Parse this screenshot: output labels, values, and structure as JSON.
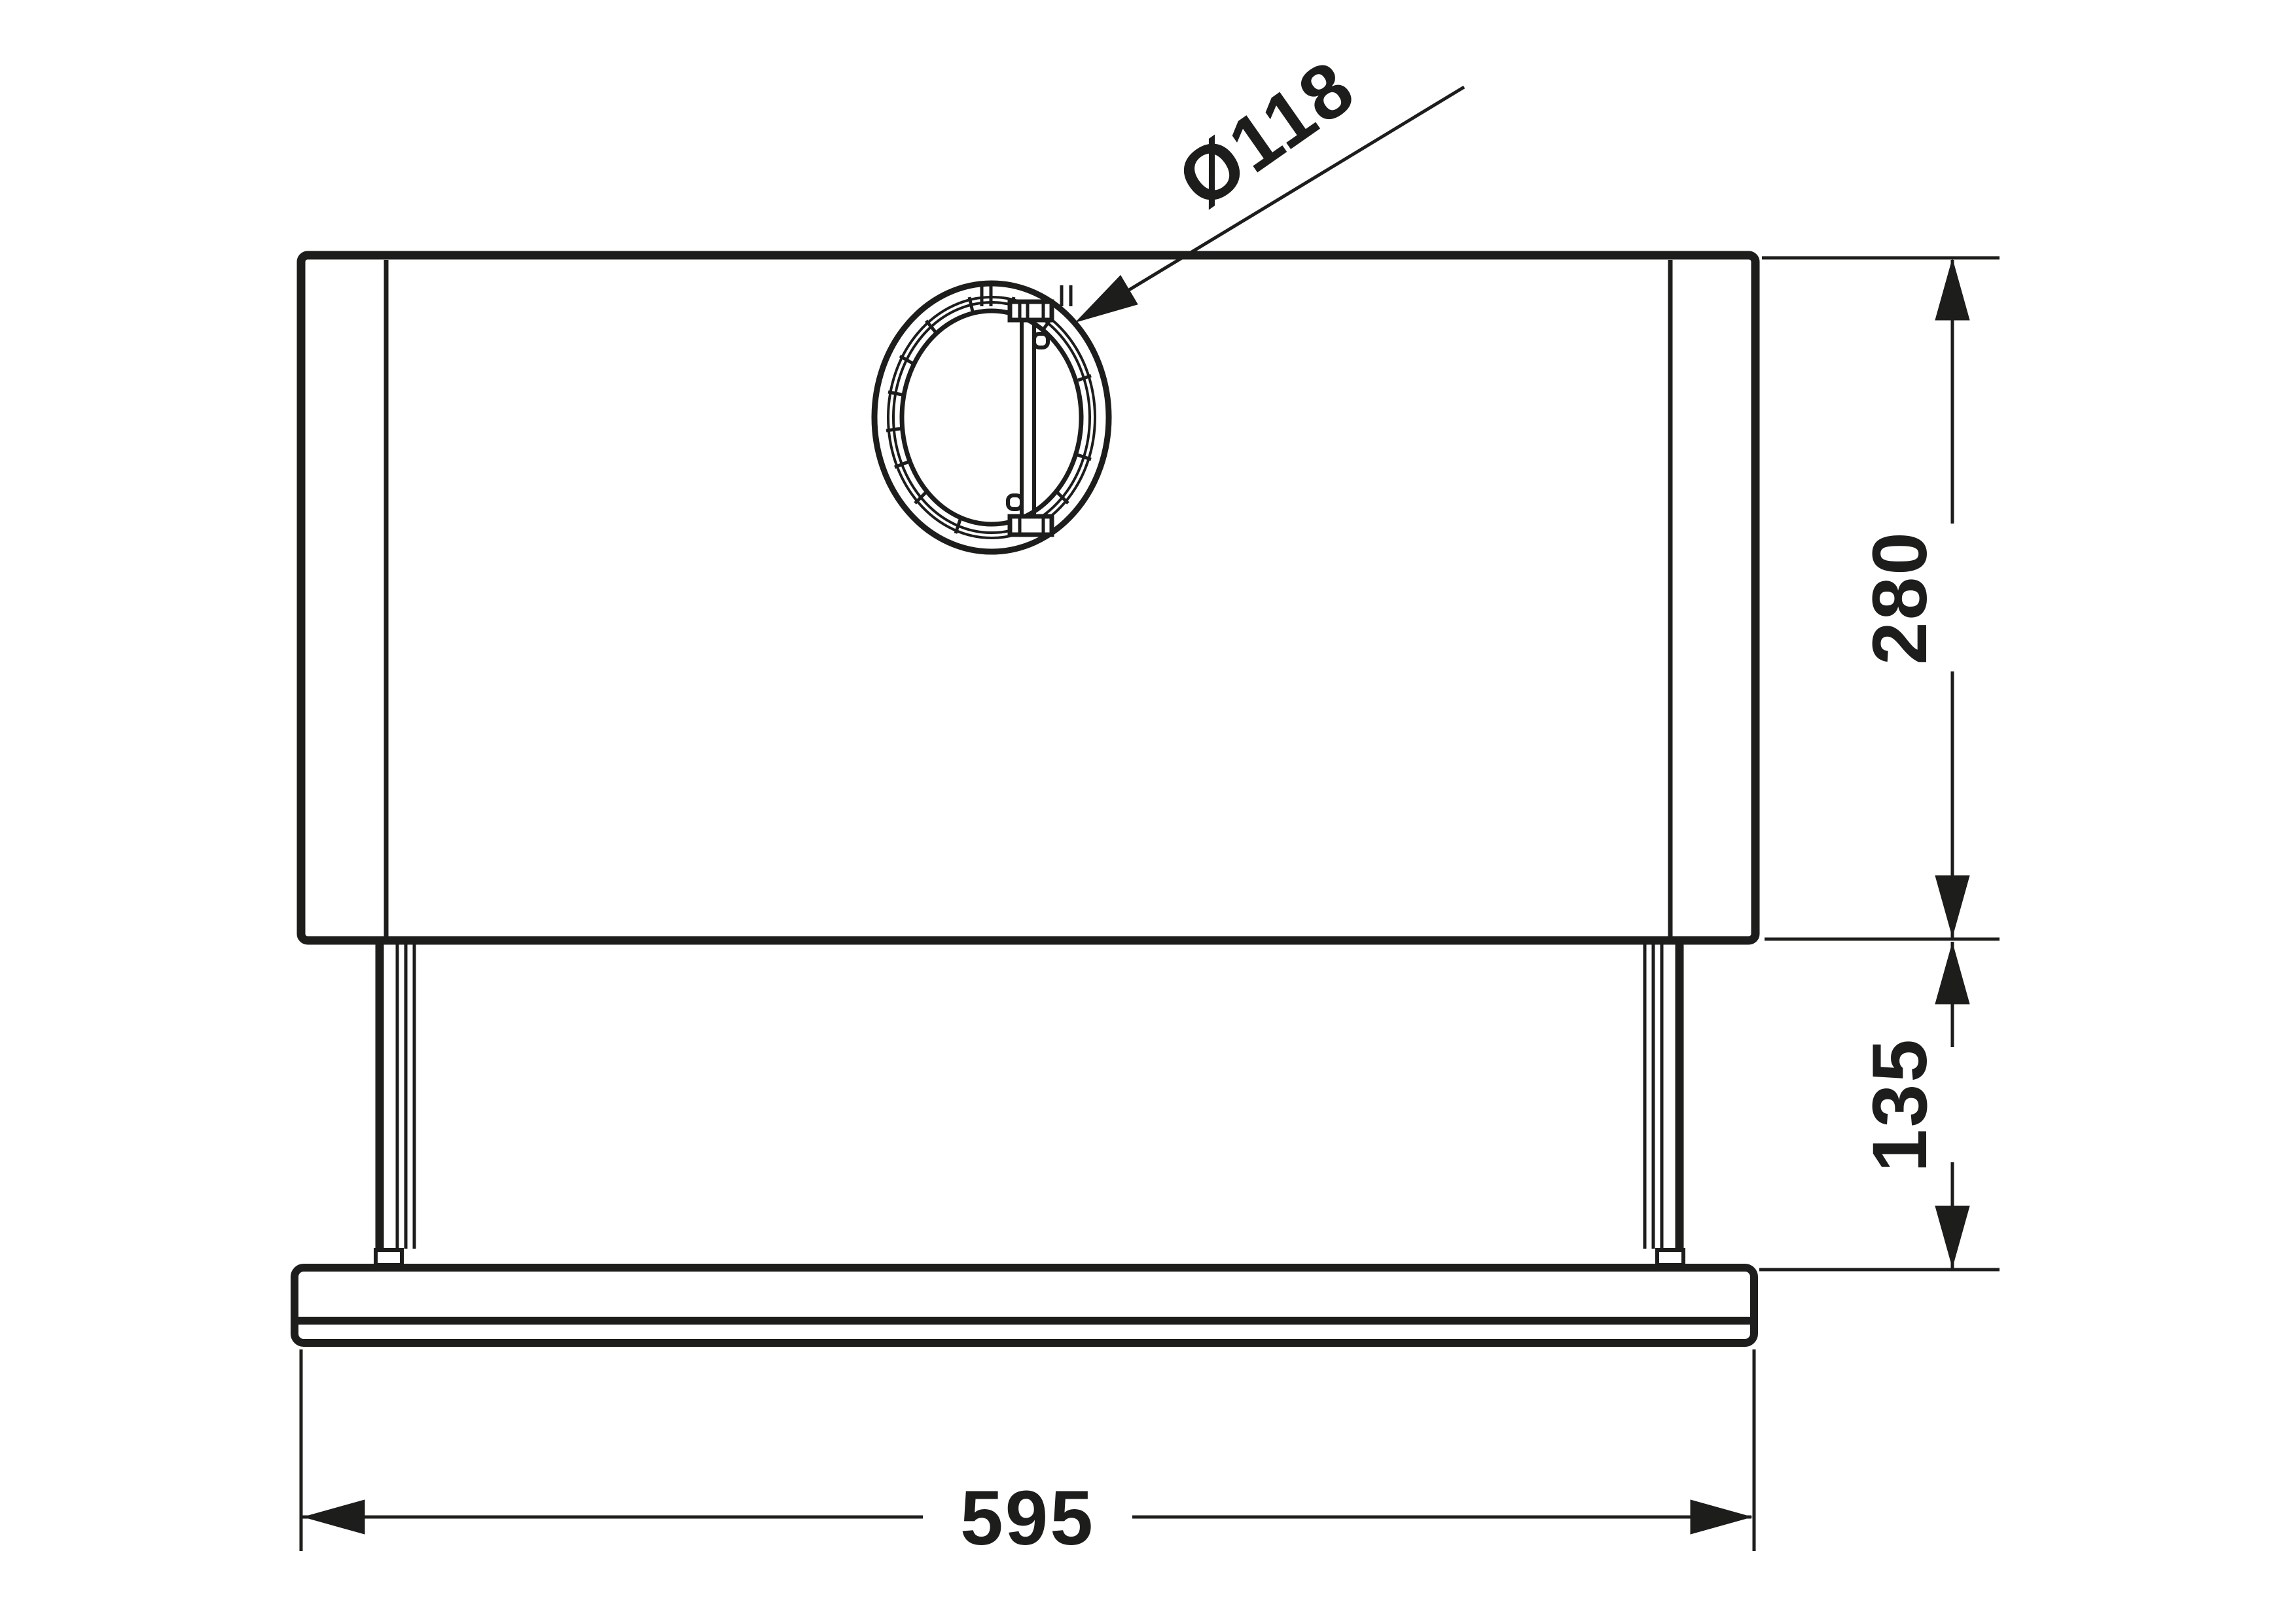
{
  "colors": {
    "line": "#1d1d1b",
    "background": "#ffffff"
  },
  "drawing": {
    "type": "technical-dimension-drawing",
    "view": "front elevation of built-in cooker hood",
    "dimensions": {
      "overall_width": {
        "value": "595"
      },
      "body_height": {
        "value": "280"
      },
      "lower_section_height": {
        "value": "135"
      },
      "duct_diameter": {
        "value": "Ø118"
      }
    }
  }
}
